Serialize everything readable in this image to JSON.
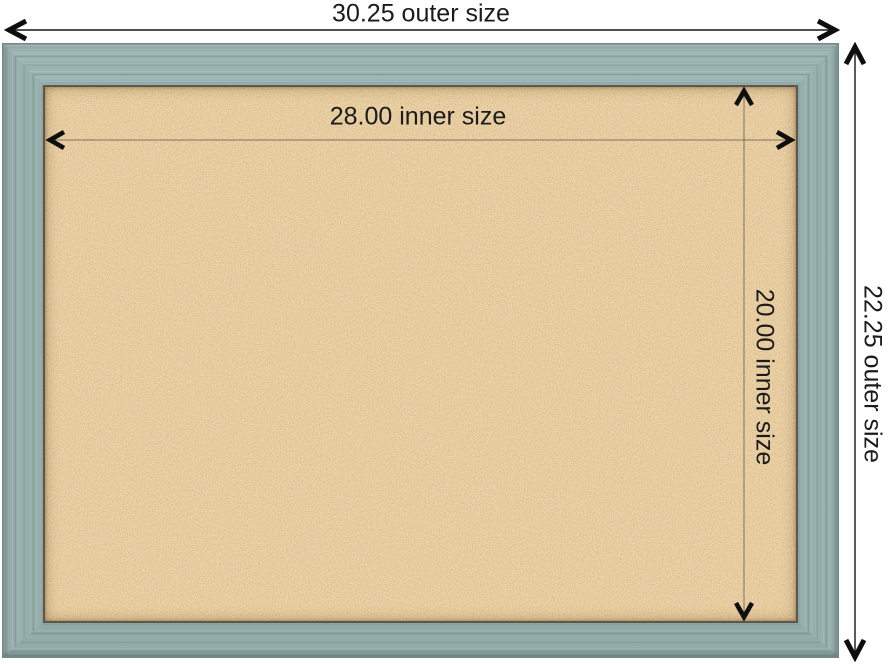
{
  "diagram": {
    "outer_width_label": "30.25 outer size",
    "outer_height_label": "22.25 outer size",
    "inner_width_label": "28.00 inner size",
    "inner_height_label": "20.00 inner size"
  },
  "colors": {
    "background": "#ffffff",
    "frame_wood": "#97b0ae",
    "frame_edge": "#758886",
    "cork_base": "#cf9e5d",
    "cork_light_speck": "#ecd0a0",
    "cork_dark_speck": "#a9763c",
    "inner_lip": "#5e564a",
    "outer_dimension_line": "#161616",
    "inner_dimension_line": "#6e6252",
    "label_text": "#1b1b1b"
  },
  "icons": {
    "arrow_left": "chevron-arrow-left",
    "arrow_right": "chevron-arrow-right",
    "arrow_up": "chevron-arrow-up",
    "arrow_down": "chevron-arrow-down"
  }
}
